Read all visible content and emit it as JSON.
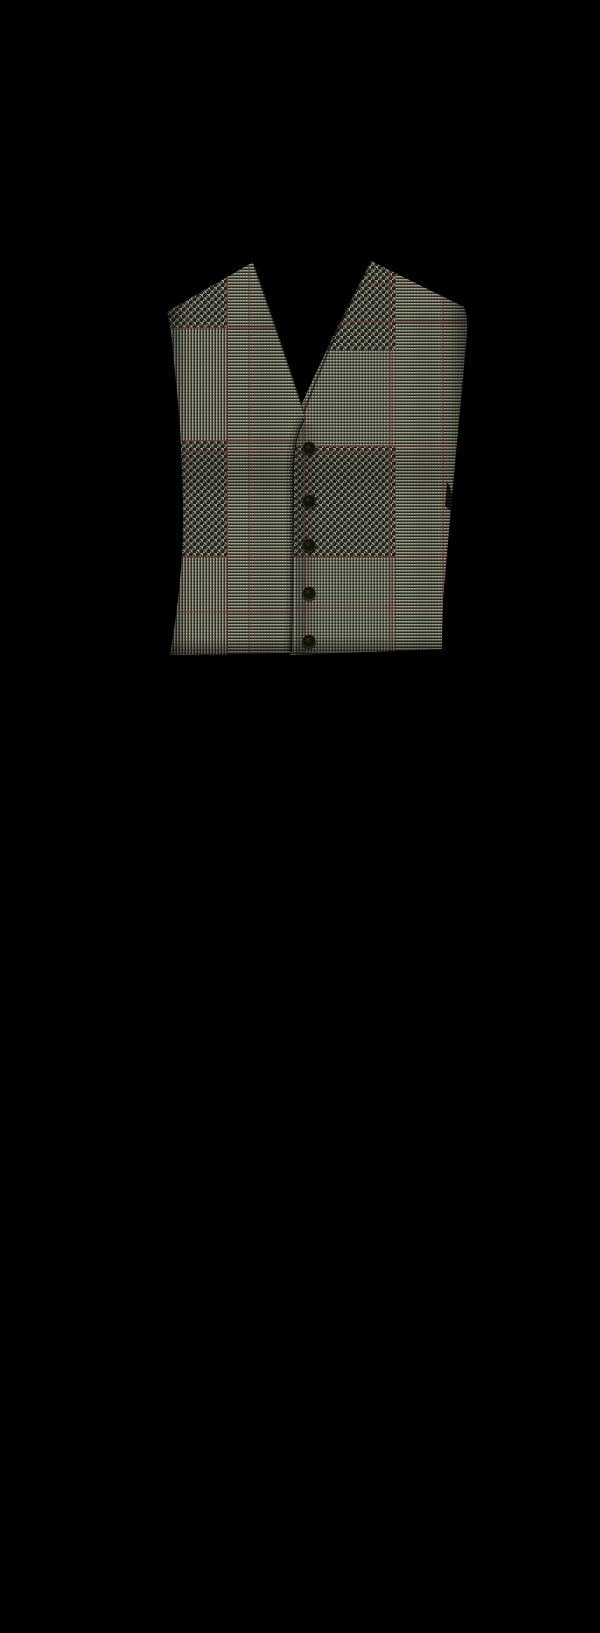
{
  "image": {
    "width": 600,
    "height": 1633,
    "background_color": "#000000",
    "subject": "Glen plaid (Prince of Wales check) five-button vest front displayed on a plain black background",
    "pattern_name": "glen check with red windowpane overcheck"
  },
  "vest": {
    "colors": {
      "fabric_light": "#a6a795",
      "fabric_mid": "#696b59",
      "fabric_dark": "#2a2c22",
      "hound_light": "#9a9b89",
      "hound_dark": "#20221a",
      "overcheck_red": "#703230",
      "button_face": "#111208",
      "button_rim": "#3c3e2e",
      "shadow": "#000000"
    },
    "outline": {
      "left_panel": "M253,262 L167,312 Q172,330 174,362 Q180,415 181,447 Q184,505 183,540 Q180,600 170,655 L292,653 Q294,560 294,470 Q294,437 306,418 Q281,341 253,262 Z",
      "right_panel": "M371,261 L464,307 Q468,318 467,332 Q461,400 456,452 Q449,530 443,600 Q442,630 442,649 L290,655 L290,430 Q330,340 371,261 Z",
      "placket_fold": "M306,419 Q295,437 294,470 L294,575 Q294,620 292,652",
      "left_neck_edge": "M253,262 Q281,341 306,418",
      "right_neck_edge": "M371,261 Q330,340 298,428",
      "right_armhole_notch": "M447,482 q7,8 5,30 l-7,-6 z"
    },
    "buttons": {
      "count": 5,
      "items": [
        {
          "x": 309,
          "y": 448
        },
        {
          "x": 309,
          "y": 501
        },
        {
          "x": 309,
          "y": 545
        },
        {
          "x": 309,
          "y": 593
        },
        {
          "x": 309,
          "y": 641
        }
      ]
    },
    "overcheck": {
      "left": {
        "vertical": [
          {
            "pos": 188,
            "o": 0.3
          },
          {
            "pos": 227,
            "o": 0.6
          },
          {
            "pos": 249,
            "o": 0.55
          }
        ],
        "horizontal": [
          {
            "pos": 328,
            "o": 0.6
          },
          {
            "pos": 441,
            "o": 0.6
          },
          {
            "pos": 452,
            "o": 0.55
          },
          {
            "pos": 557,
            "o": 0.6
          },
          {
            "pos": 612,
            "o": 0.5
          },
          {
            "pos": 650,
            "o": 0.3
          }
        ]
      },
      "right": {
        "vertical": [
          {
            "pos": 304,
            "o": 0.55
          },
          {
            "pos": 390,
            "o": 0.6
          },
          {
            "pos": 443,
            "o": 0.6
          }
        ],
        "horizontal": [
          {
            "pos": 284,
            "o": 0.35
          },
          {
            "pos": 322,
            "o": 0.6
          },
          {
            "pos": 446,
            "o": 0.6
          },
          {
            "pos": 453,
            "o": 0.55
          },
          {
            "pos": 557,
            "o": 0.6
          },
          {
            "pos": 608,
            "o": 0.5
          }
        ]
      }
    },
    "pattern_blocks": {
      "left": {
        "houndstooth": [
          {
            "x": 150,
            "y": 230,
            "w": 78,
            "h": 98
          },
          {
            "x": 150,
            "y": 441,
            "w": 78,
            "h": 116
          }
        ],
        "vertical_rib": [
          {
            "x": 150,
            "y": 328,
            "w": 78,
            "h": 113,
            "o": 0.85
          },
          {
            "x": 150,
            "y": 557,
            "w": 78,
            "h": 100,
            "o": 0.85
          }
        ]
      },
      "right": {
        "houndstooth": [
          {
            "x": 316,
            "y": 230,
            "w": 80,
            "h": 120
          },
          {
            "x": 290,
            "y": 446,
            "w": 106,
            "h": 111
          }
        ],
        "vertical_rib": [
          {
            "x": 290,
            "y": 350,
            "w": 106,
            "h": 96,
            "o": 0.3
          },
          {
            "x": 290,
            "y": 557,
            "w": 106,
            "h": 95,
            "o": 0.55
          }
        ]
      }
    }
  }
}
